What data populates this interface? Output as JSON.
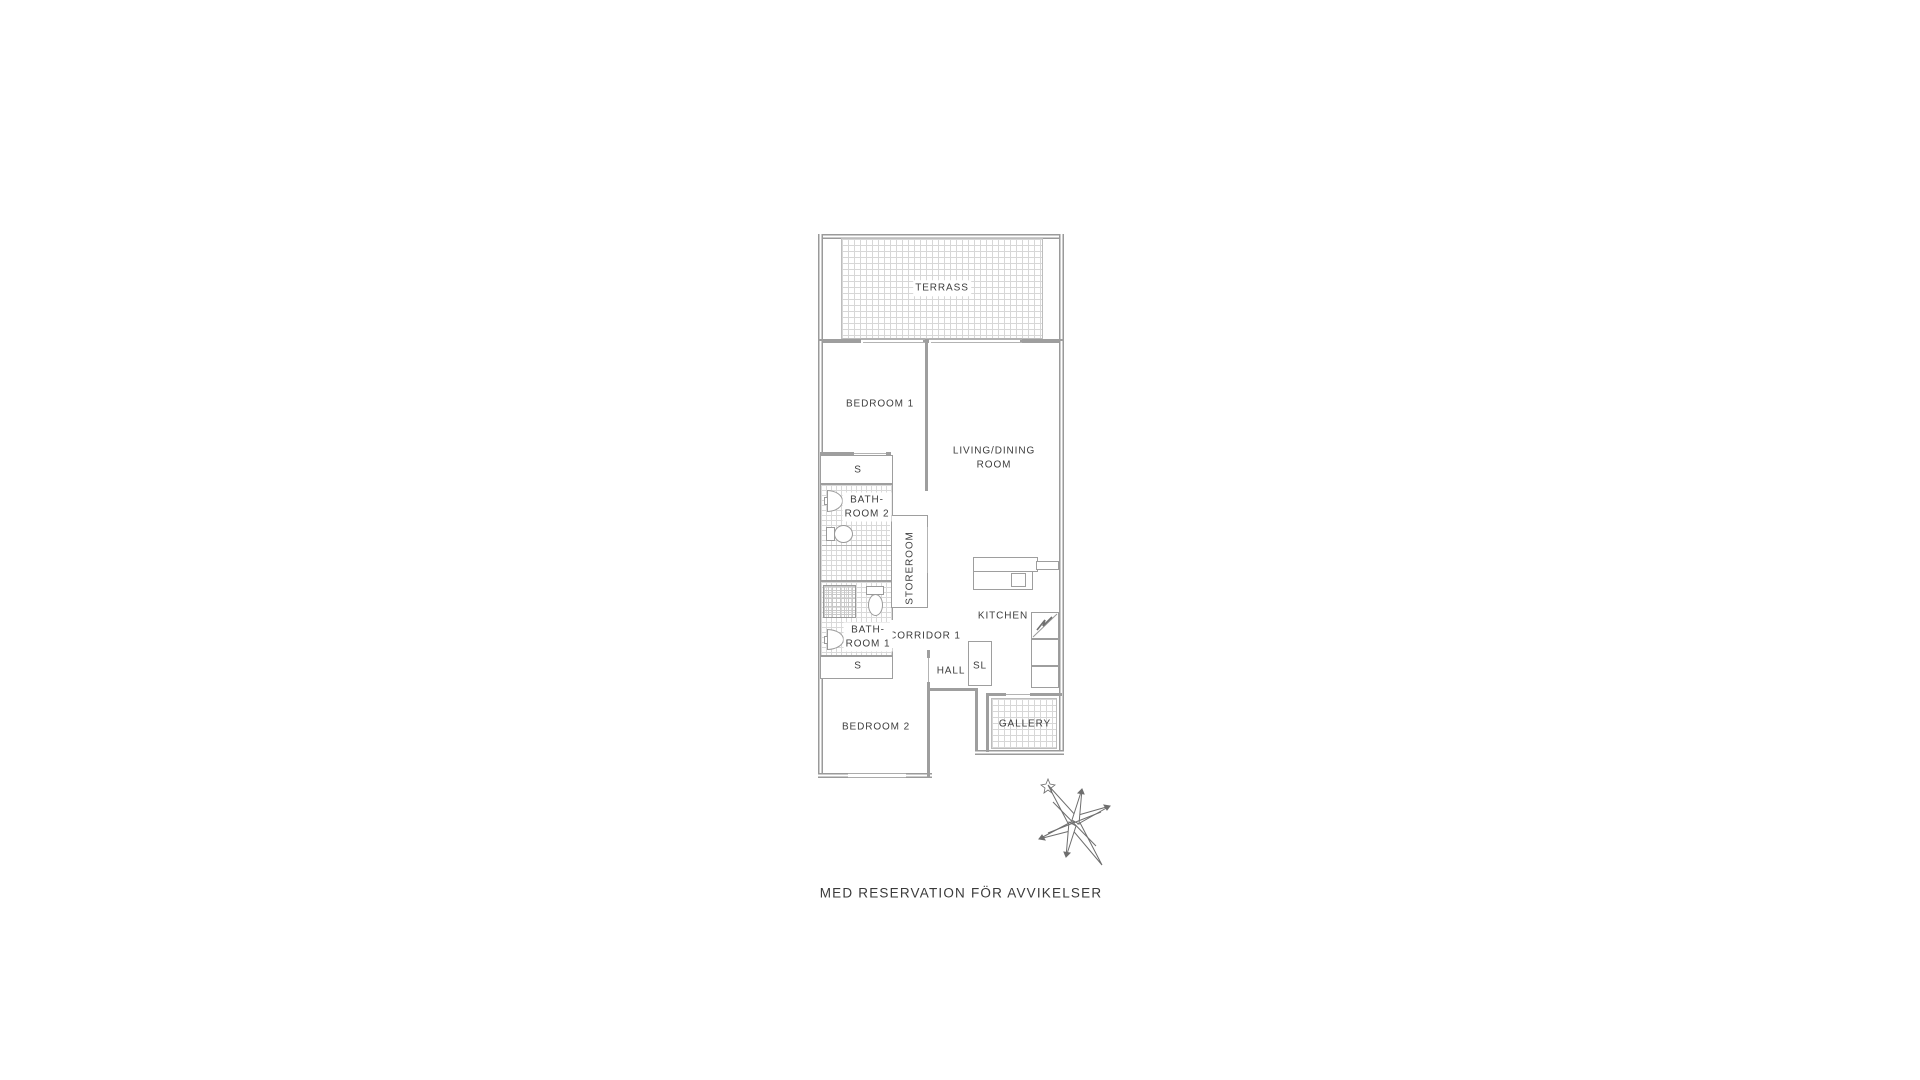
{
  "plan": {
    "wall_color": "#9a9a9a",
    "text_color": "#3d3d3d",
    "hatch_color": "#d7d7d7",
    "rooms": {
      "terrace": "TERRASS",
      "bedroom1": "BEDROOM 1",
      "living_dining": "LIVING/DINING\nROOM",
      "closet_top": "S",
      "bathroom2": "BATH-\nROOM 2",
      "storeroom": "STOREROOM",
      "kitchen": "KITCHEN",
      "corridor1": "CORRIDOR 1",
      "bathroom1": "BATH-\nROOM 1",
      "closet_bottom": "S",
      "hall": "HALL",
      "sl_closet": "SL",
      "bedroom2": "BEDROOM 2",
      "gallery": "GALLERY"
    },
    "fixtures": [
      "sink",
      "toilet",
      "shower",
      "kitchen-counter",
      "hob",
      "electrical-panel",
      "tall-cabinet"
    ],
    "compass": "north-arrow"
  },
  "footer": {
    "disclaimer": "MED RESERVATION FÖR AVVIKELSER"
  }
}
